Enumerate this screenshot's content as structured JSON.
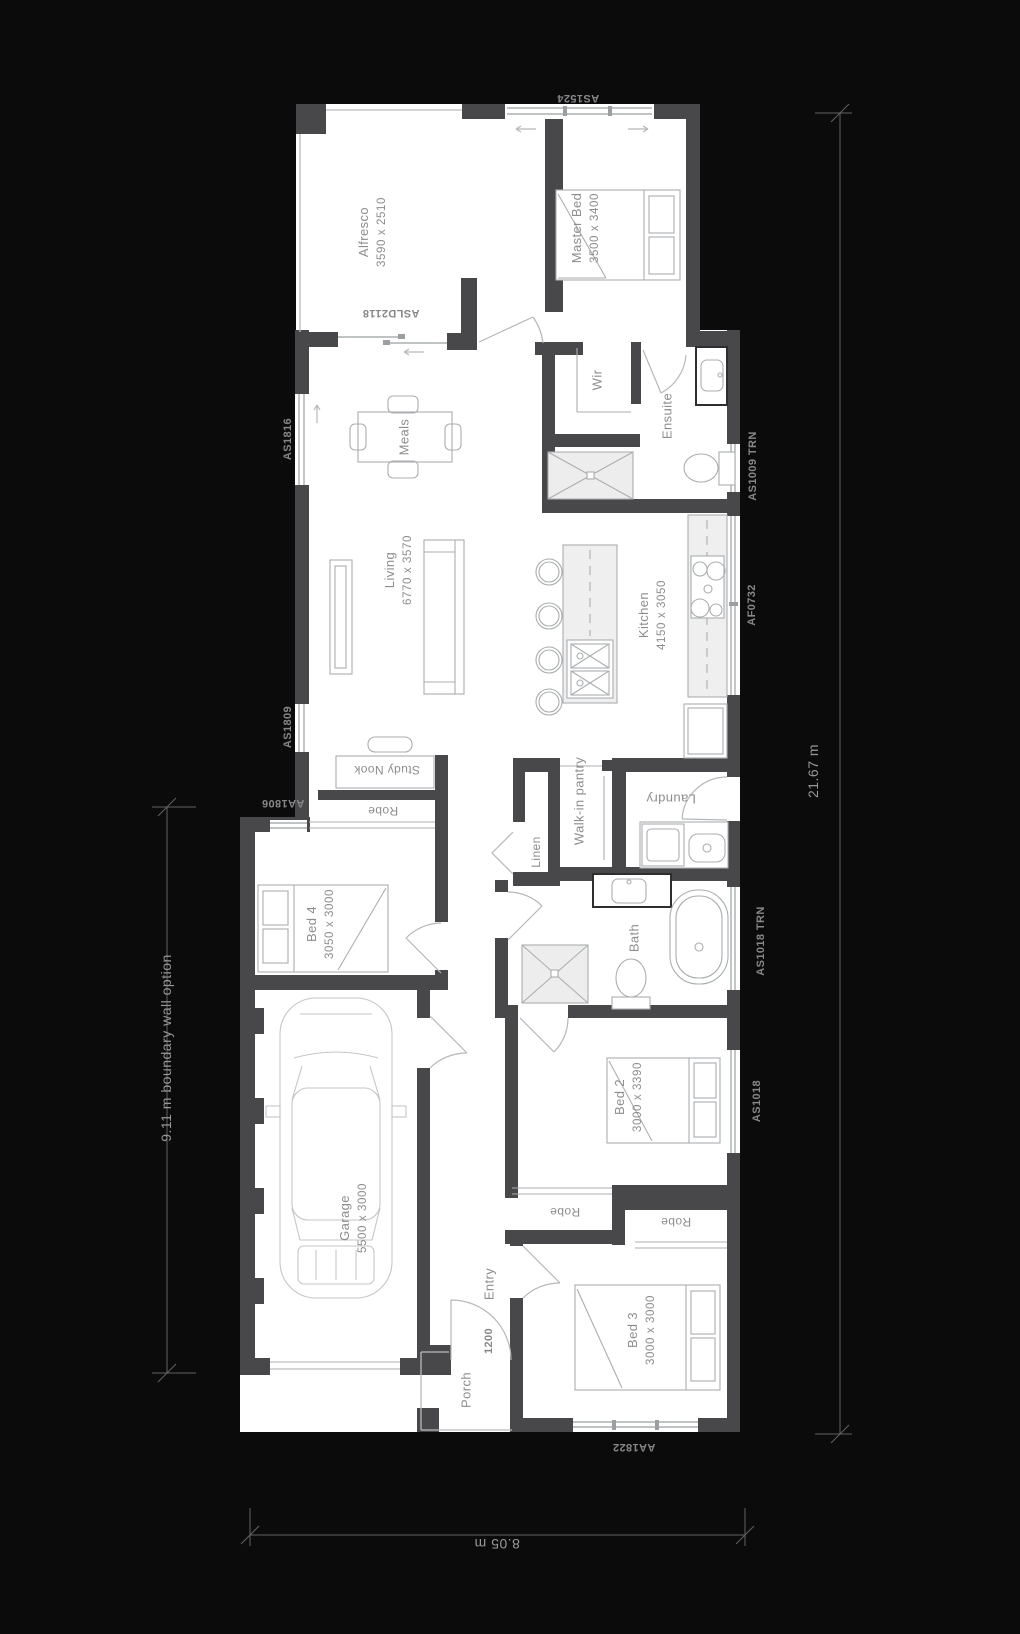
{
  "plan": {
    "title_note": "single storey house floor plan",
    "rooms": {
      "alfresco": {
        "name": "Alfresco",
        "size": "3590 x 2510"
      },
      "master_bed": {
        "name": "Master Bed",
        "size": "3500 x 3400"
      },
      "meals": {
        "name": "Meals"
      },
      "living": {
        "name": "Living",
        "size": "6770 x 3570"
      },
      "kitchen": {
        "name": "Kitchen",
        "size": "4150 x 3050"
      },
      "wir": {
        "name": "Wir"
      },
      "ensuite": {
        "name": "Ensuite"
      },
      "walk_in_pantry": {
        "line1": "Walk-in",
        "line2": "pantry"
      },
      "linen": {
        "name": "Linen"
      },
      "laundry": {
        "name": "Laundry"
      },
      "bath": {
        "name": "Bath"
      },
      "bed4": {
        "name": "Bed 4",
        "size": "3050 x 3000"
      },
      "bed2": {
        "name": "Bed 2",
        "size": "3000 x 3390"
      },
      "bed3": {
        "name": "Bed 3",
        "size": "3000 x 3000"
      },
      "garage": {
        "name": "Garage",
        "size": "5500 x 3000"
      },
      "entry": {
        "name": "Entry",
        "width_label": "1200"
      },
      "porch": {
        "name": "Porch"
      },
      "study_nook": {
        "name": "Study Nook"
      },
      "robe_bed4": {
        "name": "Robe"
      },
      "robe_bed2": {
        "name": "Robe"
      },
      "robe_bed3": {
        "name": "Robe"
      }
    },
    "codes": {
      "as1524": "AS1524",
      "asld2118": "ASLD2118",
      "as1816": "AS1816",
      "as1809": "AS1809",
      "aa1806": "AA1806",
      "as1009_trn": "AS1009 TRN",
      "af0732": "AF0732",
      "as1018_trn": "AS1018 TRN",
      "as1018": "AS1018",
      "aa1822": "AA1822"
    },
    "dimensions": {
      "overall_length": "21.67 m",
      "overall_width": "8.05 m",
      "boundary_length": "9.11 m",
      "boundary_note": "boundary wall option"
    },
    "colors": {
      "background": "#0b0b0c",
      "wall": "#48484a",
      "floor": "#ffffff",
      "furniture_line": "#a8acae",
      "label_text": "#8d8d8f"
    }
  }
}
